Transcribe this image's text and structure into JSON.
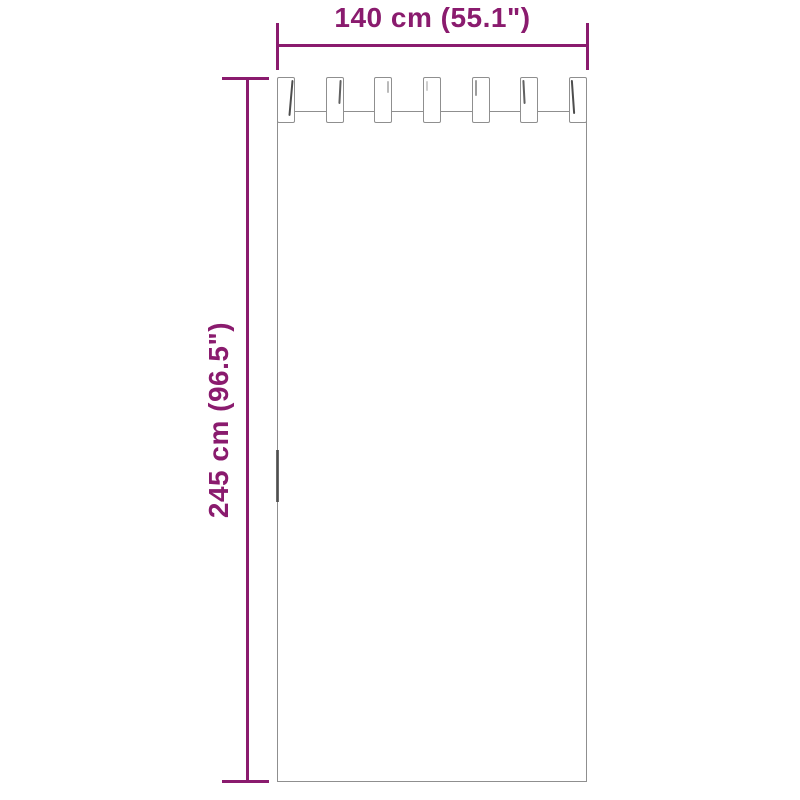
{
  "diagram": {
    "figure": "tab-top-curtain-dimension-diagram",
    "width_label": "140 cm (55.1\")",
    "height_label": "245 cm (96.5\")",
    "tab_count": 7,
    "colors": {
      "dimension": "#8A1B6E",
      "outline": "#8F8F8F",
      "fold": "#3A3A3A",
      "background": "#FFFFFF"
    }
  }
}
